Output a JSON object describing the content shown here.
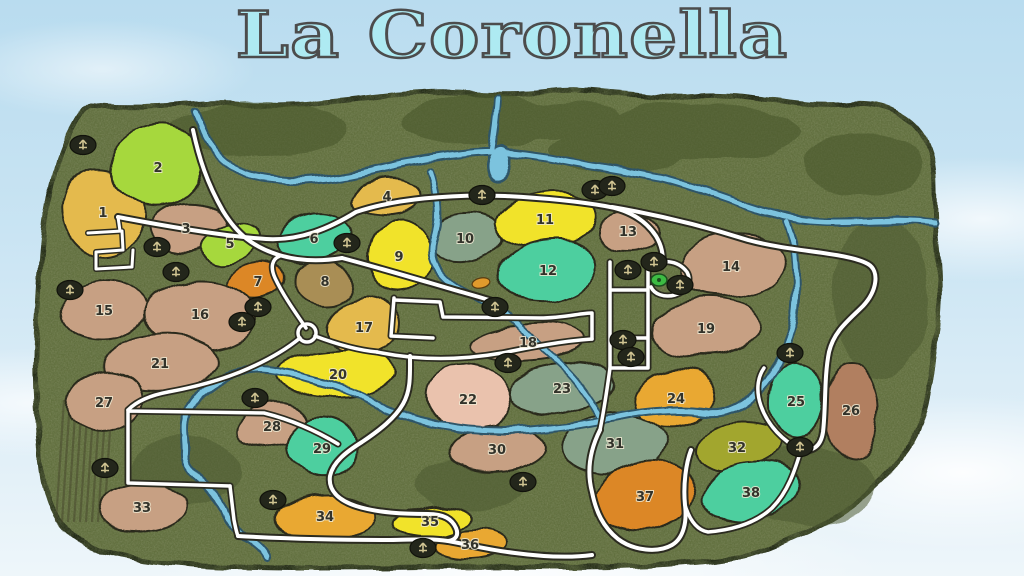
{
  "title": "La Coronella",
  "map": {
    "colors": {
      "terrain": "#64713f",
      "terrain_edge": "#232a18",
      "river": "#7cc3de",
      "river_casing": "#2e5468",
      "road": "#ffffff",
      "road_casing": "#2b2b20",
      "field_outline": "#2a2a1c",
      "number_fill": "#32322a",
      "number_halo": "#eee9d2",
      "icon_bg": "#23261b",
      "icon_glyph": "#cfc391",
      "start_marker": "#3dbb43",
      "vehicle_marker": "#e09a2c",
      "vineyard": "#46452c",
      "title_fill": "#aeeaf2",
      "title_outline": "#4c4c4c"
    },
    "palette": {
      "tan": "#c7a083",
      "yellow": "#f1e32b",
      "lime": "#a6d83e",
      "gold": "#e4ba4e",
      "amber": "#e9a833",
      "orange": "#dc8728",
      "teal": "#4ecf9f",
      "sage": "#87a289",
      "pink": "#eac2ad",
      "olive": "#a2a62e",
      "brown": "#b17f60",
      "khaki": "#a98e54"
    },
    "fields": [
      {
        "n": "1",
        "x": 103,
        "y": 212,
        "rx": 40,
        "ry": 46,
        "rot": -12,
        "c": "gold"
      },
      {
        "n": "2",
        "x": 158,
        "y": 167,
        "rx": 46,
        "ry": 40,
        "rot": -18,
        "c": "lime"
      },
      {
        "n": "3",
        "x": 186,
        "y": 228,
        "rx": 38,
        "ry": 24,
        "rot": -6,
        "c": "tan"
      },
      {
        "n": "4",
        "x": 387,
        "y": 196,
        "rx": 33,
        "ry": 17,
        "rot": -4,
        "c": "gold"
      },
      {
        "n": "5",
        "x": 230,
        "y": 243,
        "rx": 29,
        "ry": 19,
        "rot": -22,
        "c": "lime"
      },
      {
        "n": "6",
        "x": 314,
        "y": 238,
        "rx": 38,
        "ry": 24,
        "rot": -12,
        "c": "teal"
      },
      {
        "n": "7",
        "x": 258,
        "y": 281,
        "rx": 29,
        "ry": 18,
        "rot": -6,
        "c": "orange"
      },
      {
        "n": "8",
        "x": 325,
        "y": 281,
        "rx": 28,
        "ry": 22,
        "rot": 0,
        "c": "khaki"
      },
      {
        "n": "9",
        "x": 399,
        "y": 256,
        "rx": 31,
        "ry": 38,
        "rot": 4,
        "c": "yellow"
      },
      {
        "n": "10",
        "x": 465,
        "y": 238,
        "rx": 36,
        "ry": 25,
        "rot": -6,
        "c": "sage"
      },
      {
        "n": "11",
        "x": 545,
        "y": 219,
        "rx": 52,
        "ry": 27,
        "rot": -6,
        "c": "yellow"
      },
      {
        "n": "12",
        "x": 548,
        "y": 270,
        "rx": 50,
        "ry": 30,
        "rot": -8,
        "c": "teal"
      },
      {
        "n": "13",
        "x": 628,
        "y": 231,
        "rx": 29,
        "ry": 20,
        "rot": -2,
        "c": "tan"
      },
      {
        "n": "14",
        "x": 731,
        "y": 266,
        "rx": 52,
        "ry": 30,
        "rot": -6,
        "c": "tan"
      },
      {
        "n": "15",
        "x": 104,
        "y": 310,
        "rx": 43,
        "ry": 30,
        "rot": -2,
        "c": "tan"
      },
      {
        "n": "16",
        "x": 200,
        "y": 314,
        "rx": 56,
        "ry": 34,
        "rot": -2,
        "c": "tan"
      },
      {
        "n": "17",
        "x": 364,
        "y": 327,
        "rx": 39,
        "ry": 30,
        "rot": -4,
        "c": "gold"
      },
      {
        "n": "18",
        "x": 528,
        "y": 342,
        "rx": 56,
        "ry": 18,
        "rot": -3,
        "c": "tan"
      },
      {
        "n": "19",
        "x": 706,
        "y": 328,
        "rx": 56,
        "ry": 30,
        "rot": -3,
        "c": "tan"
      },
      {
        "n": "20",
        "x": 338,
        "y": 374,
        "rx": 58,
        "ry": 24,
        "rot": -3,
        "c": "yellow"
      },
      {
        "n": "21",
        "x": 160,
        "y": 363,
        "rx": 56,
        "ry": 28,
        "rot": -5,
        "c": "tan"
      },
      {
        "n": "22",
        "x": 468,
        "y": 399,
        "rx": 43,
        "ry": 36,
        "rot": 8,
        "c": "pink"
      },
      {
        "n": "23",
        "x": 562,
        "y": 388,
        "rx": 52,
        "ry": 25,
        "rot": -5,
        "c": "sage"
      },
      {
        "n": "24",
        "x": 676,
        "y": 398,
        "rx": 41,
        "ry": 29,
        "rot": -8,
        "c": "amber"
      },
      {
        "n": "25",
        "x": 796,
        "y": 401,
        "rx": 27,
        "ry": 38,
        "rot": 4,
        "c": "teal"
      },
      {
        "n": "26",
        "x": 851,
        "y": 410,
        "rx": 27,
        "ry": 47,
        "rot": -2,
        "c": "brown"
      },
      {
        "n": "27",
        "x": 104,
        "y": 402,
        "rx": 38,
        "ry": 30,
        "rot": -10,
        "c": "tan"
      },
      {
        "n": "28",
        "x": 272,
        "y": 426,
        "rx": 36,
        "ry": 22,
        "rot": -8,
        "c": "tan"
      },
      {
        "n": "29",
        "x": 322,
        "y": 448,
        "rx": 35,
        "ry": 30,
        "rot": 8,
        "c": "teal"
      },
      {
        "n": "30",
        "x": 497,
        "y": 449,
        "rx": 48,
        "ry": 22,
        "rot": -5,
        "c": "tan"
      },
      {
        "n": "31",
        "x": 615,
        "y": 443,
        "rx": 53,
        "ry": 28,
        "rot": -5,
        "c": "sage"
      },
      {
        "n": "32",
        "x": 737,
        "y": 447,
        "rx": 42,
        "ry": 25,
        "rot": -12,
        "c": "olive"
      },
      {
        "n": "33",
        "x": 142,
        "y": 507,
        "rx": 46,
        "ry": 25,
        "rot": -3,
        "c": "tan"
      },
      {
        "n": "34",
        "x": 325,
        "y": 516,
        "rx": 48,
        "ry": 21,
        "rot": -3,
        "c": "amber"
      },
      {
        "n": "35",
        "x": 430,
        "y": 521,
        "rx": 39,
        "ry": 15,
        "rot": -6,
        "c": "yellow"
      },
      {
        "n": "36",
        "x": 470,
        "y": 544,
        "rx": 36,
        "ry": 14,
        "rot": -3,
        "c": "amber"
      },
      {
        "n": "37",
        "x": 645,
        "y": 496,
        "rx": 49,
        "ry": 36,
        "rot": -5,
        "c": "orange"
      },
      {
        "n": "38",
        "x": 751,
        "y": 492,
        "rx": 49,
        "ry": 27,
        "rot": -8,
        "c": "teal"
      }
    ],
    "icons": [
      {
        "x": 83,
        "y": 145
      },
      {
        "x": 157,
        "y": 247
      },
      {
        "x": 176,
        "y": 272
      },
      {
        "x": 70,
        "y": 290
      },
      {
        "x": 347,
        "y": 243
      },
      {
        "x": 482,
        "y": 195
      },
      {
        "x": 595,
        "y": 190
      },
      {
        "x": 612,
        "y": 186
      },
      {
        "x": 628,
        "y": 270
      },
      {
        "x": 654,
        "y": 262
      },
      {
        "x": 680,
        "y": 285
      },
      {
        "x": 623,
        "y": 340
      },
      {
        "x": 631,
        "y": 357
      },
      {
        "x": 495,
        "y": 307
      },
      {
        "x": 508,
        "y": 363
      },
      {
        "x": 258,
        "y": 307
      },
      {
        "x": 242,
        "y": 322
      },
      {
        "x": 255,
        "y": 398
      },
      {
        "x": 105,
        "y": 468
      },
      {
        "x": 273,
        "y": 500
      },
      {
        "x": 423,
        "y": 548
      },
      {
        "x": 523,
        "y": 482
      },
      {
        "x": 800,
        "y": 447
      },
      {
        "x": 790,
        "y": 353
      }
    ],
    "special_markers": [
      {
        "type": "start",
        "x": 659,
        "y": 280
      },
      {
        "type": "vehicle",
        "x": 481,
        "y": 283
      }
    ],
    "vineyard": {
      "x1": 64,
      "x2": 114,
      "step": 6,
      "y1": 400,
      "y2": 522
    }
  }
}
